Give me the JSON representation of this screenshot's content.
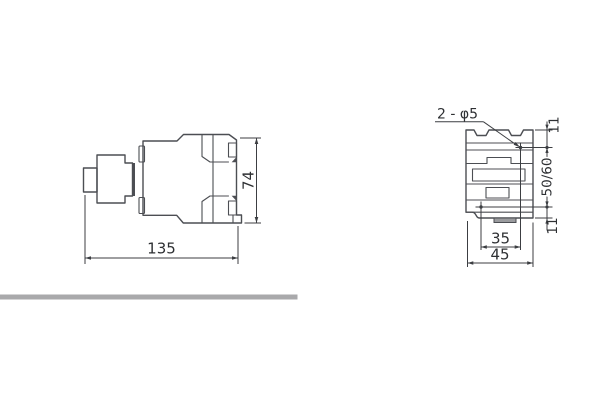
{
  "document": {
    "type": "technical-dimension-drawing"
  },
  "views": {
    "side": {
      "width_mm": "135",
      "height_mm": "74"
    },
    "front": {
      "holes_note": "2 - φ5",
      "top_margin_mm": "11",
      "mounting_pitch_mm": "50/60",
      "bottom_margin_mm": "11",
      "hole_pitch_mm": "35",
      "width_mm": "45"
    }
  },
  "colors": {
    "outline": "#4c4e53",
    "dimension": "#3c3e42",
    "text": "#2e3033",
    "accent_fill": "#9a9b9e",
    "divider": "#a9a9ab",
    "background": "#ffffff"
  }
}
